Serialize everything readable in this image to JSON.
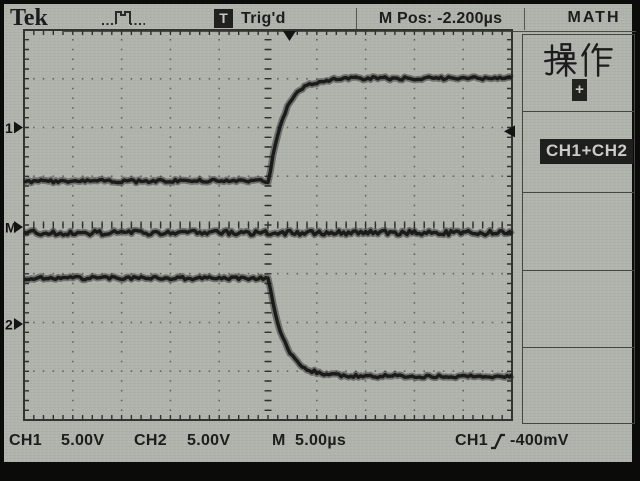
{
  "top_bar": {
    "logo": "Tek",
    "acquisition_icon": "pulse-waveform",
    "trigger_badge": "T",
    "trigger_status": "Trig'd",
    "horizontal_position_readout": "M Pos: -2.200µs",
    "menu_title": "MATH"
  },
  "sidebar": {
    "menu": [
      {
        "title": "操作",
        "badge": "+"
      },
      {
        "selected": "CH1+CH2"
      },
      {
        "label": ""
      },
      {
        "label": ""
      },
      {
        "label": ""
      }
    ]
  },
  "left_markers": [
    {
      "label": "1"
    },
    {
      "label": "M"
    },
    {
      "label": "2"
    }
  ],
  "bottom_bar": {
    "ch1_label": "CH1",
    "ch1_scale": "5.00V",
    "ch2_label": "CH2",
    "ch2_scale": "5.00V",
    "time_label": "M",
    "time_scale": "5.00µs",
    "trigger_source": "CH1",
    "trigger_slope_icon": "rising-edge",
    "trigger_level": "-400mV"
  },
  "chart_data": {
    "type": "line",
    "title": "Oscilloscope display: CH1 rising step, CH2 falling step, MATH=CH1+CH2 constant",
    "x_divisions": 10,
    "y_divisions": 8,
    "timebase_per_div": "5.00µs",
    "minor_per_div": 5,
    "trigger": {
      "source": "CH1",
      "level": "-400mV",
      "slope": "rising",
      "m_pos": "-2.200µs",
      "marker_x_div_from_center": 0.44,
      "level_marker_y_div_from_center": 1.92
    },
    "series": [
      {
        "name": "CH1",
        "volts_per_div": 5,
        "marker_label": "1",
        "ref_marker_div": 2.0,
        "flat_before_div": 0.9,
        "flat_after_div": 3.01,
        "edge_start_div_from_center": 0.02,
        "tau_div": 0.3,
        "shape": "rising-exponential-step",
        "noise_div": 0.035,
        "low_volts": -5.4,
        "high_volts": 5.1
      },
      {
        "name": "MATH",
        "expr": "CH1+CH2",
        "marker_label": "M",
        "ref_marker_div": -0.04,
        "flat_before_div": -0.16,
        "flat_after_div": -0.16,
        "shape": "flat",
        "noise_div": 0.05
      },
      {
        "name": "CH2",
        "volts_per_div": 5,
        "marker_label": "2",
        "ref_marker_div": -2.03,
        "flat_before_div": -1.09,
        "flat_after_div": -3.1,
        "edge_start_div_from_center": 0.02,
        "tau_div": 0.3,
        "shape": "falling-exponential-step",
        "noise_div": 0.035,
        "high_volts": 4.7,
        "low_volts": -5.4
      }
    ]
  }
}
